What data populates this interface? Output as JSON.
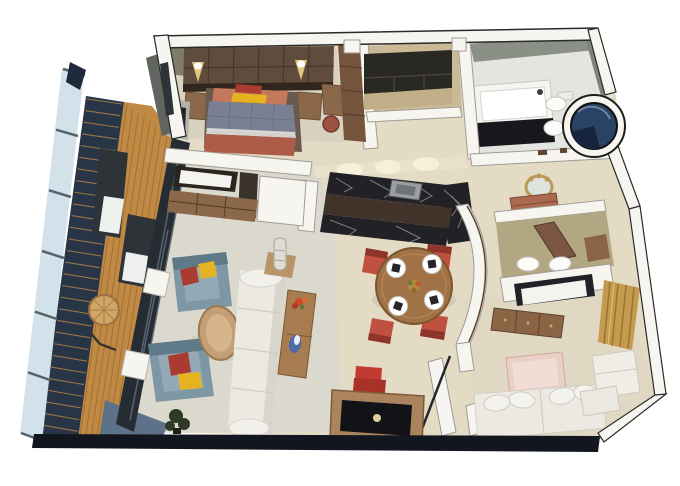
{
  "image": {
    "kind": "3d-isometric-floor-plan-rendering",
    "width": 680,
    "height": 486
  },
  "palette": {
    "outline": "#1f1f1f",
    "wallWhite": "#f7f5f0",
    "wallShade": "#d9d6cd",
    "creamWall": "#eae1cb",
    "floorCream": "#e4dbc5",
    "floorBedroom": "#d8d1bf",
    "floorLiving": "#dbd8cd",
    "floorBath": "#e4e4e0",
    "floorCloset": "#c9ba95",
    "floorNook": "#b3a783",
    "floorRoom2": "#e0d8c2",
    "bathWall": "#8b9086",
    "bathWallDark": "#7d827a",
    "deckWood": "#c08a44",
    "deckLine": "#8a5c28",
    "railNavy": "#273547",
    "railCap": "#1e2a3a",
    "glassPale": "#d3e1ea",
    "glassPost": "#55636e",
    "steelBlue": "#5d7288",
    "bottomDark": "#12171f",
    "glassDoorDark": "#262c33",
    "glassStreak": "#59646e",
    "grayFace": "#60655f",
    "oliveWall": "#7e7d68",
    "headboard": "#5f4c3c",
    "headboardLine": "#43352a",
    "woodMid": "#8a6849",
    "woodDark": "#75553b",
    "woodLight": "#a8835e",
    "sconceGlow": "#f2d484",
    "salmonPillow": "#c4785c",
    "redPillow": "#ab3a30",
    "yellowPillow": "#e5b322",
    "duvet": "#7b7f93",
    "duvetLine": "#696d81",
    "benchTerracotta": "#ad5c49",
    "tvDark": "#1f2226",
    "screenWhite": "#f3f3ef",
    "cabinetEspresso": "#2a2823",
    "counterTan": "#bfae87",
    "marbleDark": "#222126",
    "marbleVein": "#d3d4d8",
    "barCabinet": "#41332a",
    "sinkGray": "#9aa0a2",
    "tubWhite": "#f4f4f0",
    "tubPanel": "#17181c",
    "fixtureWhite": "#fbfbf9",
    "showerNavy": "#2a4263",
    "showerDeep": "#16243d",
    "tableWood": "#a07245",
    "tableWoodEdge": "#7c5430",
    "chairRed": "#c0503f",
    "chairRedDark": "#8e352b",
    "entryChairRed": "#c23b32",
    "napkinDark": "#26262a",
    "chairBlue": "#7e97a5",
    "chairBlueDark": "#5e7a89",
    "chairBlueSeat": "#93aab6",
    "sofaIvory": "#ebe9e1",
    "sofaShade": "#d8d6ca",
    "consoleWood": "#a67c50",
    "flowerRed": "#cc4a28",
    "blueDecor": "#4f68a8",
    "coffeeWood": "#c49e74",
    "coffeeWoodEdge": "#9a7850",
    "wickerTan": "#d0a566",
    "loungerDark": "#2e3338",
    "mirrorGold": "#bb9a58",
    "mirrorGlass": "#dfe3df",
    "vanityRose": "#a96a50",
    "doorWood": "#7b5642",
    "curtainGold": "#c49a4e",
    "curtainStripe": "#9a7432",
    "pinkTable": "#e9cfc6",
    "dresserWood": "#8a6444",
    "trimBrown": "#5e4430",
    "plantGreen": "#2e3a26",
    "lampSilver": "#dfdcd4",
    "deskWoodEntry": "#ab845e"
  },
  "procedural": {
    "deck_planks": 9,
    "louver_slats": 30,
    "glass_posts": 7
  },
  "scene": {
    "balcony": {
      "items": [
        "glass-railing",
        "louver-panel",
        "wood-deck",
        "lounger",
        "lounger",
        "round-wicker-table"
      ]
    },
    "bedroom": {
      "items": [
        "headboard-panel",
        "wall-sconce",
        "wall-sconce",
        "double-bed",
        "nightstand",
        "nightstand",
        "foot-bench",
        "desk",
        "stool",
        "wardrobe",
        "wall-tv"
      ]
    },
    "walk_in_closet": {
      "items": [
        "dark-cabinets",
        "counter"
      ]
    },
    "bathroom": {
      "items": [
        "bathtub",
        "toilet",
        "bidet",
        "round-shower"
      ]
    },
    "kitchen_bar": {
      "items": [
        "marble-counter",
        "sink",
        "bar-cabinet"
      ]
    },
    "dining": {
      "chairs": 4,
      "place_settings": 4,
      "items": [
        "round-dining-table",
        "centerpiece"
      ]
    },
    "living": {
      "items": [
        "armchair",
        "armchair",
        "coffee-table",
        "sofa",
        "console-table",
        "table-lamp",
        "plant",
        "media-wall-tv",
        "media-cabinet"
      ]
    },
    "vanity_hall": {
      "items": [
        "ornate-mirror",
        "vanity-table",
        "curved-wall"
      ]
    },
    "dressing_nook": {
      "items": [
        "wood-door",
        "towel",
        "towel",
        "shelf"
      ]
    },
    "second_room": {
      "items": [
        "wall-tv",
        "dresser",
        "gold-curtain",
        "low-table",
        "sofa-bed",
        "armchair",
        "ottoman"
      ]
    },
    "entry": {
      "items": [
        "open-door",
        "tv-desk",
        "red-chair"
      ]
    }
  }
}
